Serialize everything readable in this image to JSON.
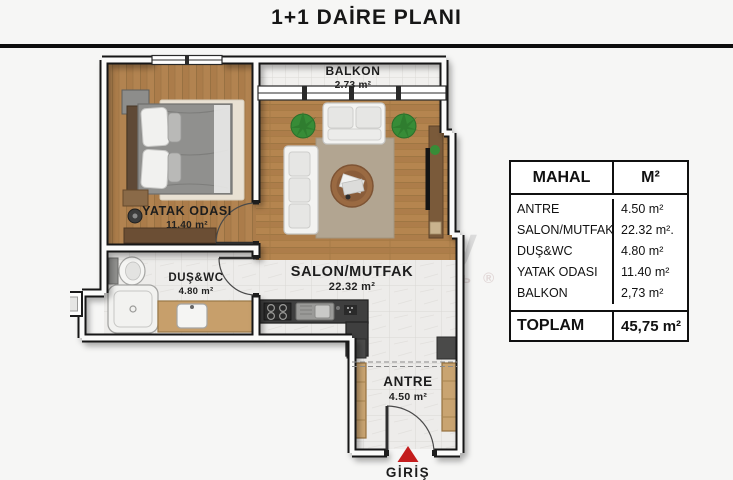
{
  "title": "1+1 DAİRE PLANI",
  "watermark": {
    "line1": "est property",
    "line2": "зарубежная недвижимость ®"
  },
  "plan": {
    "rooms": [
      {
        "id": "balkon",
        "name": "BALKON",
        "area": "2.73 m²"
      },
      {
        "id": "yatak-odasi",
        "name": "YATAK ODASI",
        "area": "11.40 m²"
      },
      {
        "id": "salon-mutfak",
        "name": "SALON/MUTFAK",
        "area": "22.32 m²"
      },
      {
        "id": "dus-wc",
        "name": "DUŞ&WC",
        "area": "4.80 m²"
      },
      {
        "id": "antre",
        "name": "ANTRE",
        "area": "4.50 m²"
      }
    ],
    "entrance_label": "GİRİŞ",
    "entrance_arrow_color": "#c41d1d"
  },
  "table": {
    "headers": {
      "room": "MAHAL",
      "area": "M²"
    },
    "rows": [
      {
        "room": "ANTRE",
        "area": "4.50 m²"
      },
      {
        "room": "SALON/MUTFAK",
        "area": "22.32 m²."
      },
      {
        "room": "DUŞ&WC",
        "area": "4.80 m²"
      },
      {
        "room": "YATAK ODASI",
        "area": "11.40 m²"
      },
      {
        "room": "BALKON",
        "area": "2,73 m²"
      }
    ],
    "total": {
      "room": "TOPLAM",
      "area": "45,75 m²"
    }
  },
  "colors": {
    "wall": "#161616",
    "wood_floor": "#b28350",
    "tile_floor": "#edecea",
    "counter": "#3f3f3f",
    "cabinet_wood": "#c9a471",
    "accent_red": "#c41d1d"
  }
}
